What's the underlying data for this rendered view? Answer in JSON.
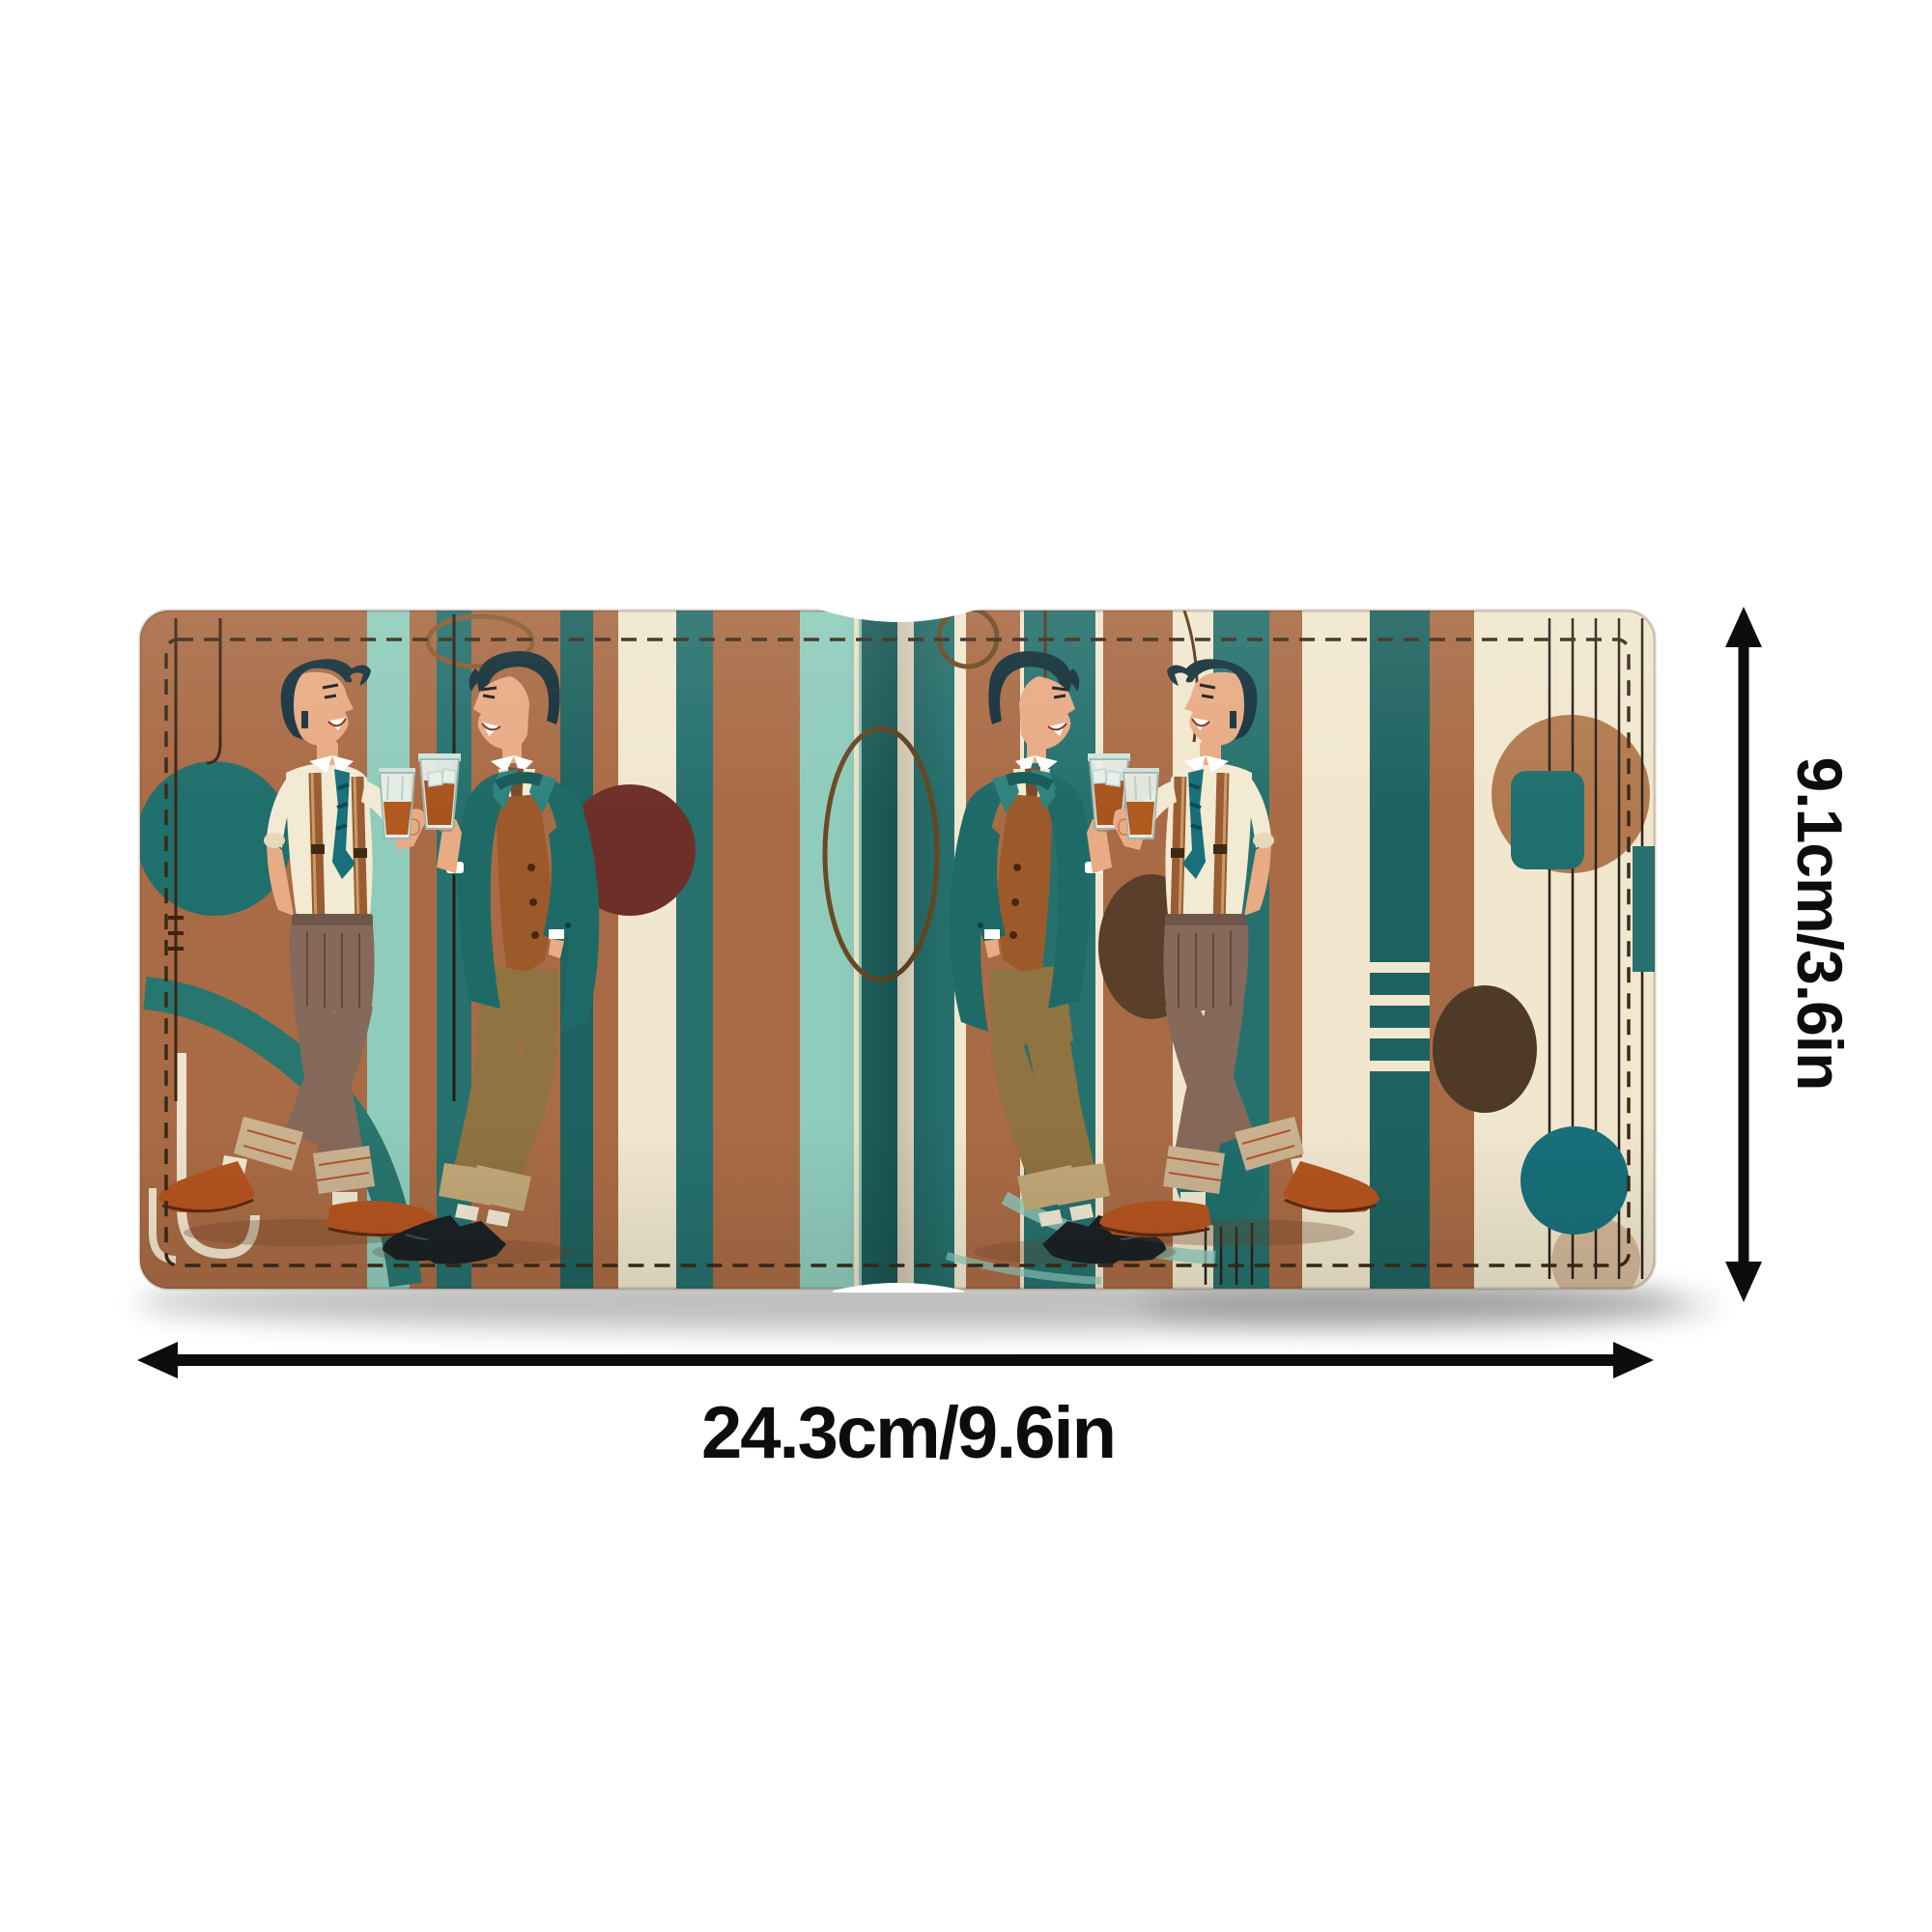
{
  "meta": {
    "image_type": "product-dimension-diagram",
    "alt": "Open bifold wallet printed with a retro mid-century illustration of two men toasting whiskey glasses against teal, brown and cream stripes and circles"
  },
  "dimensions": {
    "width_label": "24.3cm/9.6in",
    "height_label": "9.1cm/3.6in"
  },
  "icons": {
    "width_arrow": "horizontal-double-arrow-icon",
    "height_arrow": "vertical-double-arrow-icon"
  },
  "palette": {
    "page_background": "#ffffff",
    "annotation_black": "#0d0d0d",
    "leather_copper": "#a96b45",
    "cream": "#f1e7ce",
    "teal": "#26716d",
    "teal_dark": "#1e6360",
    "aqua": "#8fccbc",
    "maroon": "#6e2f28",
    "dark_brown": "#4f3a28",
    "suit_teal": "#1e6a67",
    "vest_copper": "#9c5a2a",
    "trouser_taupe": "#85695a",
    "trouser_khaki": "#8f7340",
    "shoe_cognac": "#b5541f",
    "shoe_black": "#1b2124",
    "skin": "#e8ab84",
    "hair": "#15323c",
    "stitch": "#3b2a18",
    "whiskey": "#a8541e"
  }
}
